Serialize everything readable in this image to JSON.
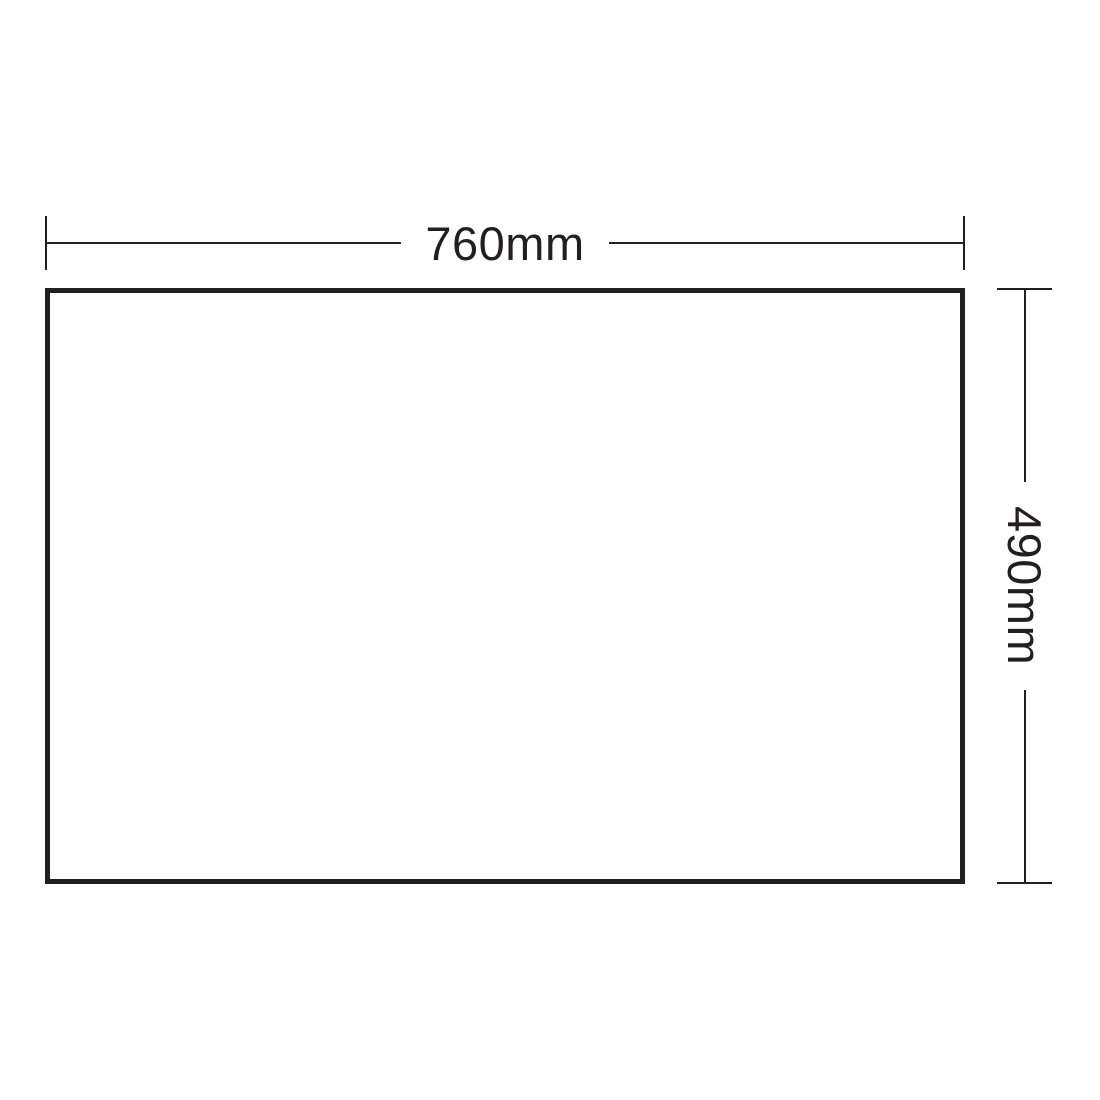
{
  "colors": {
    "line-color": "#231f20",
    "background": "#ffffff"
  },
  "diagram": {
    "type": "dimension-drawing",
    "shape": "rectangle",
    "width_label": "760mm",
    "height_label": "490mm"
  }
}
